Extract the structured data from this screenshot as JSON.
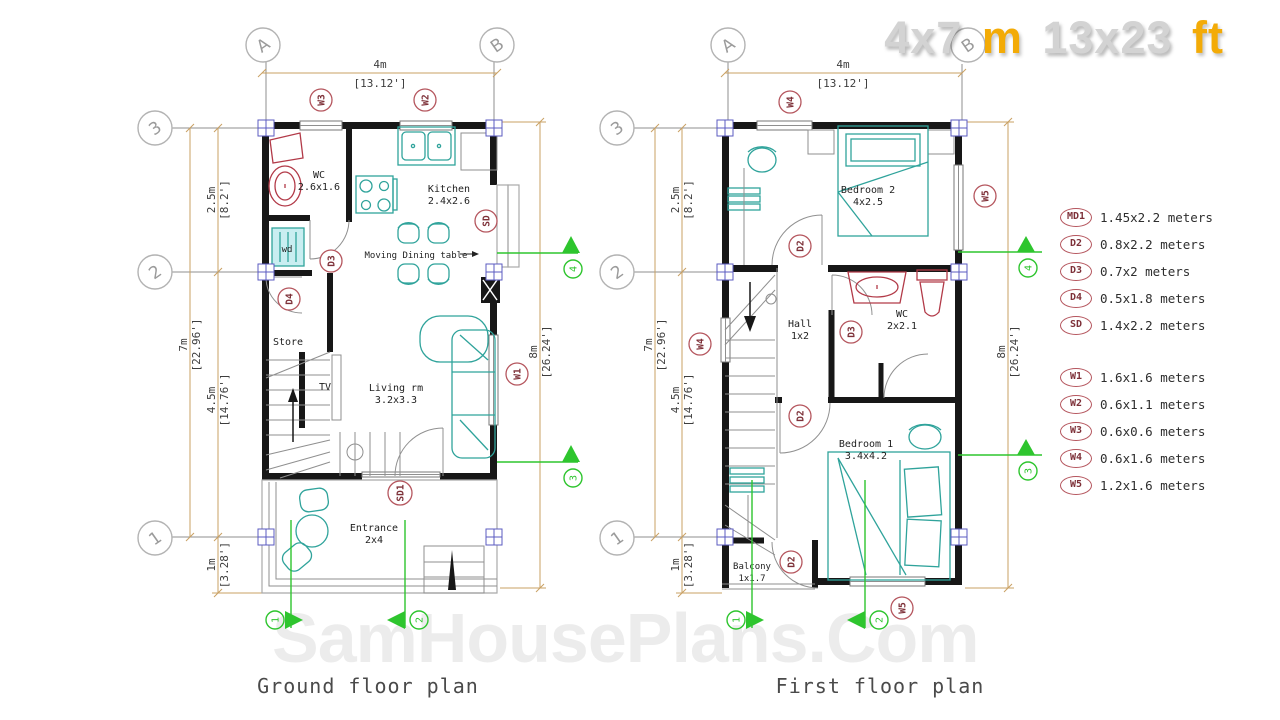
{
  "title": {
    "m_value": "4x7",
    "m_unit": "m",
    "ft_value": "13x23",
    "ft_unit": "ft"
  },
  "watermark": "SamHousePlans.Com",
  "captions": {
    "ground": "Ground floor plan",
    "first": "First floor plan"
  },
  "legend": {
    "doors": [
      {
        "tag": "MD1",
        "size": "1.45x2.2 meters"
      },
      {
        "tag": "D2",
        "size": "0.8x2.2 meters"
      },
      {
        "tag": "D3",
        "size": "0.7x2 meters"
      },
      {
        "tag": "D4",
        "size": "0.5x1.8 meters"
      },
      {
        "tag": "SD",
        "size": "1.4x2.2 meters"
      }
    ],
    "windows": [
      {
        "tag": "W1",
        "size": "1.6x1.6 meters"
      },
      {
        "tag": "W2",
        "size": "0.6x1.1 meters"
      },
      {
        "tag": "W3",
        "size": "0.6x0.6 meters"
      },
      {
        "tag": "W4",
        "size": "0.6x1.6 meters"
      },
      {
        "tag": "W5",
        "size": "1.2x1.6 meters"
      }
    ]
  },
  "dims": {
    "width_m": "4m",
    "width_ft": "[13.12']",
    "height_m": "8m",
    "height_ft": "[26.24']",
    "seg_top_m": "2.5m",
    "seg_top_ft": "[8.2']",
    "total_m": "7m",
    "total_ft": "[22.96']",
    "seg_mid_m": "4.5m",
    "seg_mid_ft": "[14.76']",
    "seg_bottom_m": "1m",
    "seg_bottom_ft": "[3.28']"
  },
  "grid": {
    "col_a": "A",
    "col_b": "B",
    "row_3": "3",
    "row_2": "2",
    "row_1": "1"
  },
  "sections": {
    "s1": "1",
    "s2": "2",
    "s3": "3",
    "s4": "4"
  },
  "ground": {
    "rooms": {
      "wc": "WC",
      "wc_size": "2.6x1.6",
      "wd": "wd",
      "kitchen": "Kitchen",
      "kitchen_size": "2.4x2.6",
      "dining_note": "Moving Dining table",
      "store": "Store",
      "tv": "TV",
      "living": "Living rm",
      "living_size": "3.2x3.3",
      "entrance": "Entrance",
      "entrance_size": "2x4"
    },
    "tags": {
      "w3": "W3",
      "w2": "W2",
      "d3": "D3",
      "d4": "D4",
      "sd": "SD",
      "w1": "W1",
      "sd1": "SD1"
    }
  },
  "first": {
    "rooms": {
      "bedroom2": "Bedroom 2",
      "bedroom2_size": "4x2.5",
      "hall": "Hall",
      "hall_size": "1x2",
      "wc": "WC",
      "wc_size": "2x2.1",
      "bedroom1": "Bedroom 1",
      "bedroom1_size": "3.4x4.2",
      "balcony": "Balcony",
      "balcony_size": "1x1.7"
    },
    "tags": {
      "w4_top": "W4",
      "d2_bed2": "D2",
      "w5_right": "W5",
      "w4_left": "W4",
      "d3": "D3",
      "d2_hall": "D2",
      "d2_balcony": "D2",
      "w5_bottom": "W5"
    }
  },
  "colors": {
    "wall": "#171717",
    "furniture": "#2fa39b",
    "fixture": "#b23a48",
    "dimension": "#c9a063",
    "section_marker": "#2ec52e",
    "tag": "#b5565e",
    "grid": "#9b9b9b",
    "title_gray": "#d3d3d3",
    "title_yellow": "#f3ab07"
  }
}
